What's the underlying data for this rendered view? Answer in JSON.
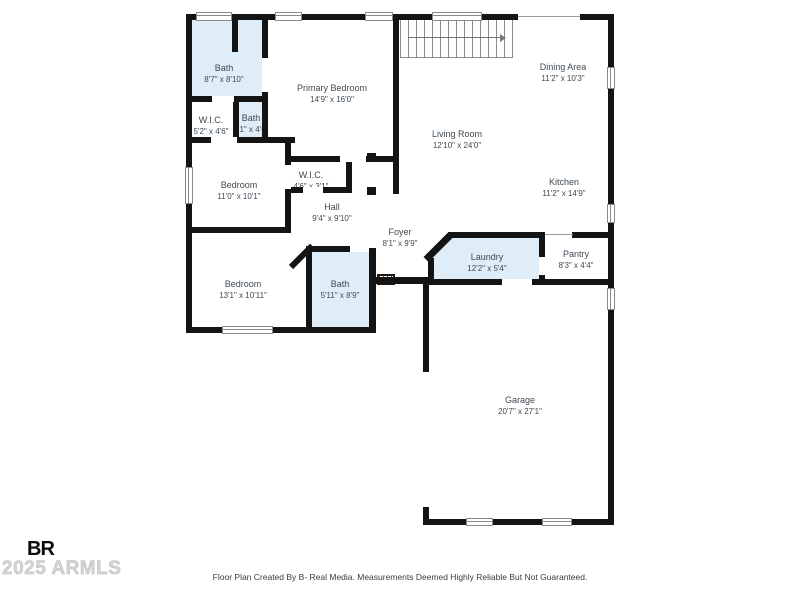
{
  "page": {
    "background": "#ffffff"
  },
  "rooms": [
    {
      "id": "bath-primary",
      "name": "Bath",
      "dims": "8'7\" x 8'10\""
    },
    {
      "id": "wic-primary",
      "name": "W.I.C.",
      "dims": "5'2\" x 4'6\""
    },
    {
      "id": "bath-2",
      "name": "Bath",
      "dims": "7'1\" x 4'6\""
    },
    {
      "id": "primary-bedroom",
      "name": "Primary Bedroom",
      "dims": "14'9\" x 16'0\""
    },
    {
      "id": "dining-area",
      "name": "Dining Area",
      "dims": "11'2\" x 10'3\""
    },
    {
      "id": "living-room",
      "name": "Living Room",
      "dims": "12'10\" x 24'0\""
    },
    {
      "id": "kitchen",
      "name": "Kitchen",
      "dims": "11'2\" x 14'9\""
    },
    {
      "id": "bedroom-1",
      "name": "Bedroom",
      "dims": "11'0\" x 10'1\""
    },
    {
      "id": "wic-2",
      "name": "W.I.C.",
      "dims": "4'6\" x 3'1\""
    },
    {
      "id": "hall",
      "name": "Hall",
      "dims": "9'4\" x 9'10\""
    },
    {
      "id": "foyer",
      "name": "Foyer",
      "dims": "8'1\" x 9'9\""
    },
    {
      "id": "laundry",
      "name": "Laundry",
      "dims": "12'2\" x 5'4\""
    },
    {
      "id": "pantry",
      "name": "Pantry",
      "dims": "8'3\" x 4'4\""
    },
    {
      "id": "bedroom-2",
      "name": "Bedroom",
      "dims": "13'1\" x 10'11\""
    },
    {
      "id": "bath-3",
      "name": "Bath",
      "dims": "5'11\" x 8'9\""
    },
    {
      "id": "garage",
      "name": "Garage",
      "dims": "20'7\" x 27'1\""
    }
  ],
  "footer": {
    "disclaimer": "Floor Plan Created By B- Real Media. Measurements Deemed Highly Reliable But Not Guaranteed."
  },
  "watermark": {
    "logo": "BR",
    "text": "2025 ARMLS"
  },
  "colors": {
    "room_fill": "#deedf7",
    "wall": "#141414",
    "label": "#3f4a54",
    "watermark": "#d4d4d4"
  }
}
